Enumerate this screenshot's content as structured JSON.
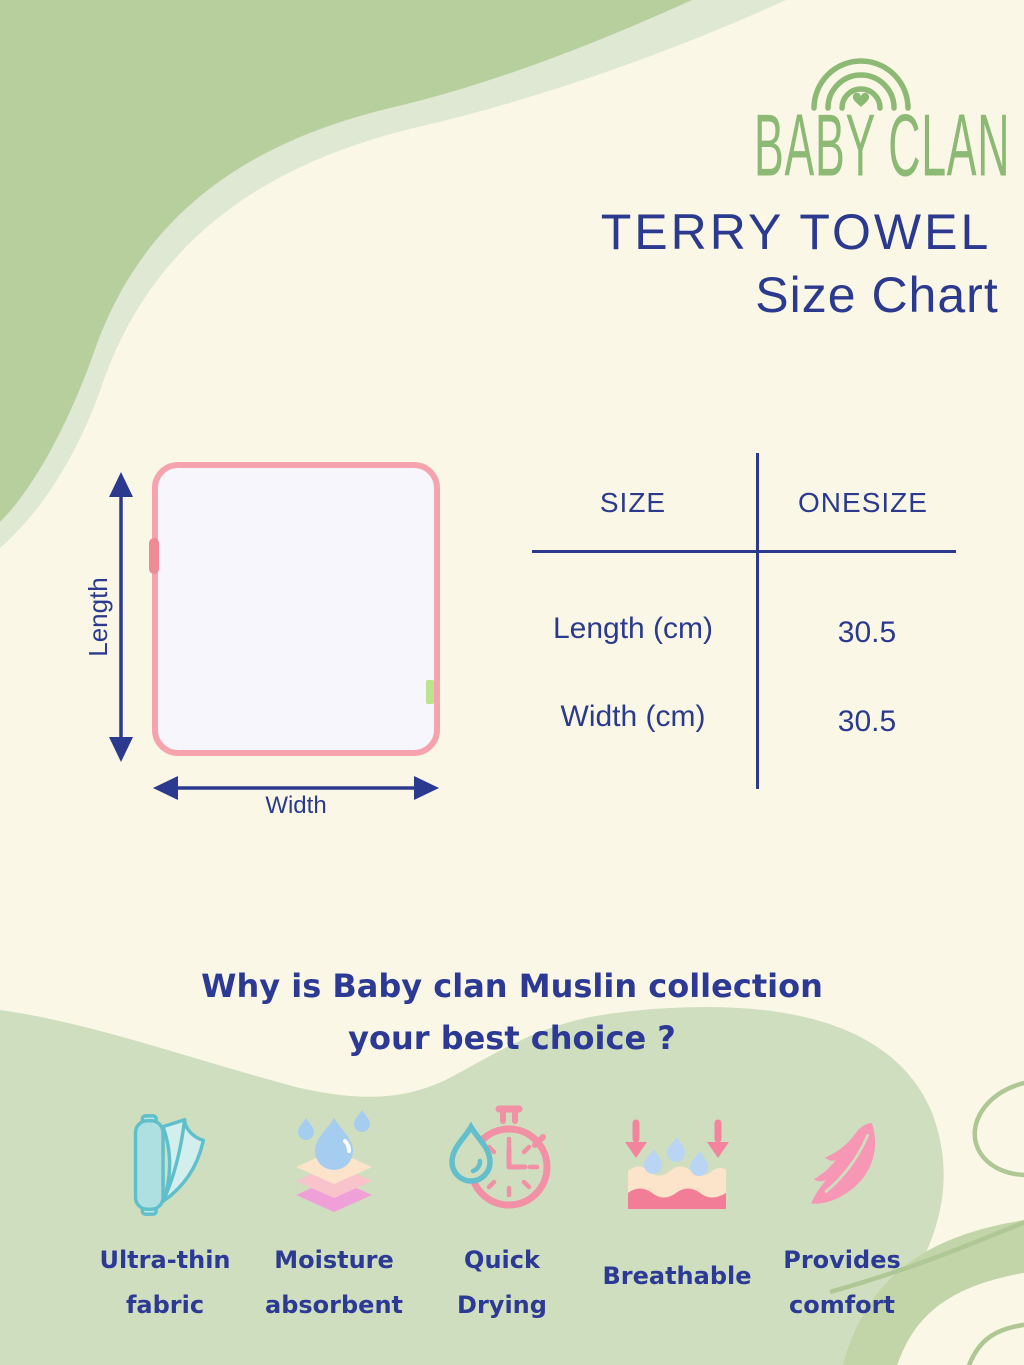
{
  "brand": {
    "name": "BABY CLAN"
  },
  "header": {
    "product": "TERRY TOWEL",
    "subtitle": "Size Chart"
  },
  "towel_diagram": {
    "length_label": "Length",
    "width_label": "Width"
  },
  "size_table": {
    "col_size": "SIZE",
    "col_onesize": "ONESIZE",
    "rows": [
      {
        "label": "Length (cm)",
        "value": "30.5"
      },
      {
        "label": "Width (cm)",
        "value": "30.5"
      }
    ]
  },
  "why_section": {
    "heading_line1": "Why is Baby clan Muslin collection",
    "heading_line2": "your best choice ?"
  },
  "features": [
    {
      "icon": "fabric-roll-icon",
      "line1": "Ultra-thin",
      "line2": "fabric"
    },
    {
      "icon": "moisture-layers-icon",
      "line1": "Moisture",
      "line2": "absorbent"
    },
    {
      "icon": "stopwatch-waterdrop-icon",
      "line1": "Quick",
      "line2": "Drying"
    },
    {
      "icon": "breathable-fabric-icon",
      "line1": "Breathable",
      "line2": ""
    },
    {
      "icon": "feather-icon",
      "line1": "Provides",
      "line2": "comfort"
    }
  ],
  "colors": {
    "background_cream": "#FAF7E6",
    "blob_green_dark": "#B7CF9D",
    "blob_green_light_band": "#DEE8D2",
    "blob_green_bottom": "#CFDEBF",
    "ribbon_green": "#C2D5A8",
    "outline_green": "#AFC795",
    "navy_text": "#2B3A8F",
    "logo_green": "#8CBA74",
    "towel_border_pink": "#F5A3AD",
    "icon_teal": "#63BFCB",
    "icon_pink": "#F290A6",
    "drop_blue": "#A5CDEF",
    "feather_pink": "#F796B5"
  }
}
